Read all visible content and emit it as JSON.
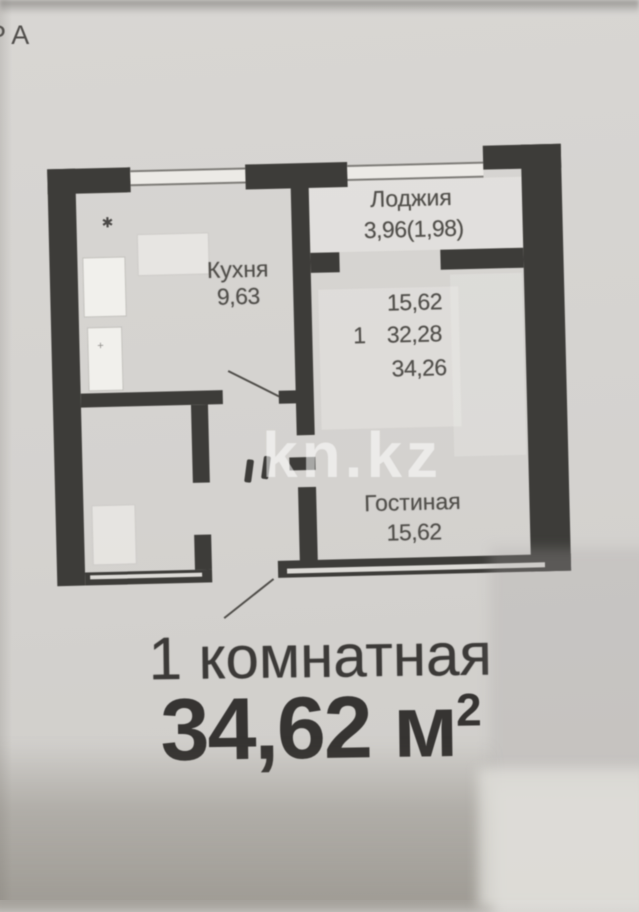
{
  "photo": {
    "corner_label": "РА",
    "watermark": "kn.kz"
  },
  "floor_plan": {
    "loggia": {
      "label": "Лоджия",
      "area": "3,96(1,98)"
    },
    "kitchen": {
      "label": "Кухня",
      "area": "9,63"
    },
    "living_room": {
      "label": "Гостиная",
      "area": "15,62"
    },
    "area_summary": {
      "rooms_count": "1",
      "living_area": "15,62",
      "area_without_loggia": "32,28",
      "total_area": "34,26"
    },
    "markers": {
      "asterisk": "✱",
      "small_mark": "+"
    },
    "colors": {
      "wall": "#3d3c39",
      "paper": "#d4d2cf",
      "label_text": "#514f4b",
      "caption_text": "#363432",
      "watermark_white": "rgba(255,255,255,0.55)"
    }
  },
  "caption": {
    "title": "1 комнатная",
    "area_value": "34,62",
    "area_unit": "м",
    "area_sup": "2"
  }
}
